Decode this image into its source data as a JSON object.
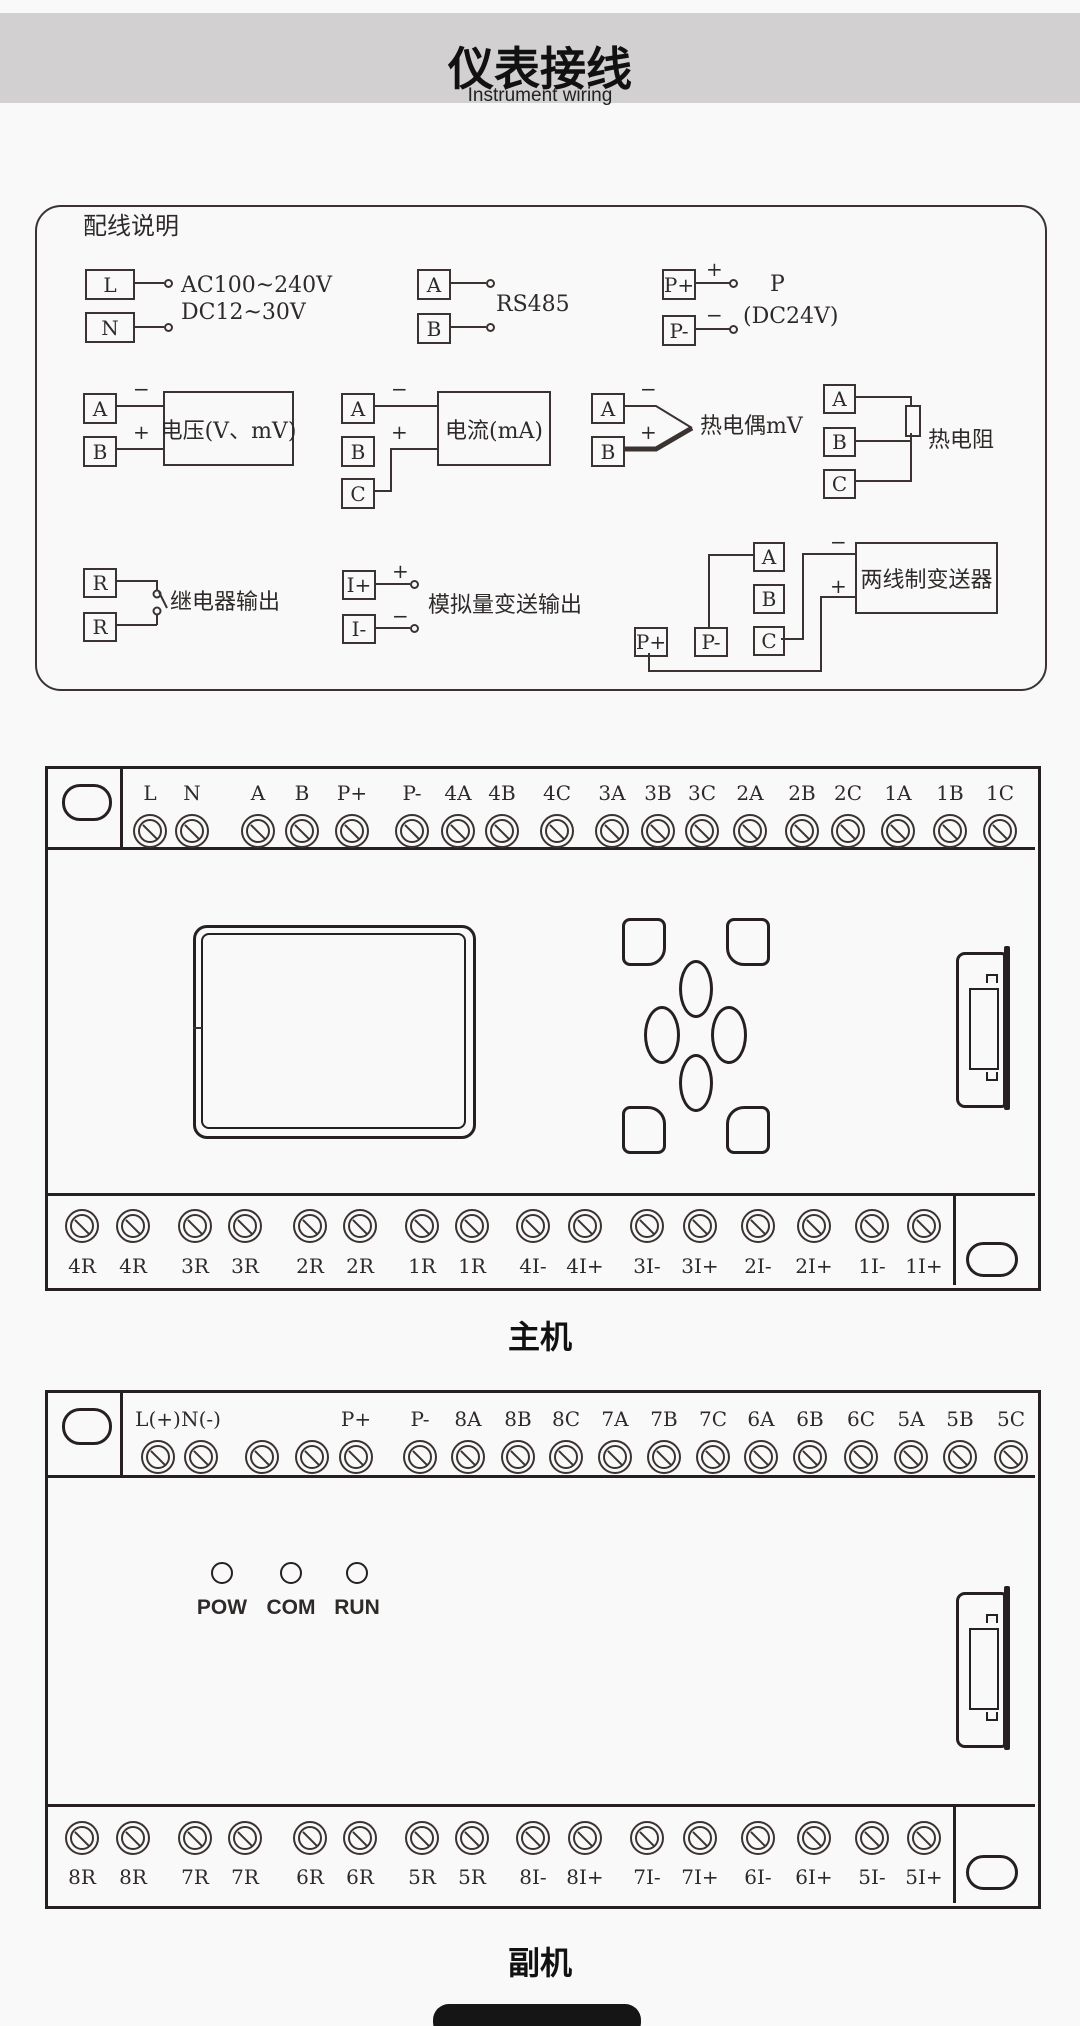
{
  "header": {
    "title": "仪表接线",
    "subtitle": "Instrument wiring"
  },
  "wiring_box": {
    "title": "配线说明",
    "power": {
      "t1": "L",
      "t2": "N",
      "label1": "AC100~240V",
      "label2": "DC12~30V"
    },
    "rs485": {
      "t1": "A",
      "t2": "B",
      "label": "RS485"
    },
    "dc24": {
      "t1": "P+",
      "t2": "P-",
      "plus": "+",
      "minus": "−",
      "label1": "P",
      "label2": "(DC24V)"
    },
    "voltage": {
      "t1": "A",
      "t2": "B",
      "minus": "−",
      "plus": "+",
      "label": "电压(V、mV)"
    },
    "current": {
      "t1": "A",
      "t2": "B",
      "t3": "C",
      "minus": "−",
      "plus": "+",
      "label": "电流(mA)"
    },
    "thermocouple": {
      "t1": "A",
      "t2": "B",
      "minus": "−",
      "plus": "+",
      "label": "热电偶mV"
    },
    "rtd": {
      "t1": "A",
      "t2": "B",
      "t3": "C",
      "label": "热电阻"
    },
    "relay": {
      "t1": "R",
      "t2": "R",
      "label": "继电器输出"
    },
    "analog_out": {
      "t1": "I+",
      "t2": "I-",
      "plus": "+",
      "minus": "−",
      "label": "模拟量变送输出"
    },
    "transmitter": {
      "t1": "P+",
      "t2": "P-",
      "t3": "A",
      "t4": "B",
      "t5": "C",
      "minus": "−",
      "plus": "+",
      "label": "两线制变送器"
    }
  },
  "main_unit": {
    "caption": "主机",
    "top_terminals": [
      "L",
      "N",
      "A",
      "B",
      "P+",
      "P-",
      "4A",
      "4B",
      "4C",
      "3A",
      "3B",
      "3C",
      "2A",
      "2B",
      "2C",
      "1A",
      "1B",
      "1C"
    ],
    "bottom_terminals": [
      "4R",
      "4R",
      "3R",
      "3R",
      "2R",
      "2R",
      "1R",
      "1R",
      "4I-",
      "4I+",
      "3I-",
      "3I+",
      "2I-",
      "2I+",
      "1I-",
      "1I+"
    ]
  },
  "aux_unit": {
    "caption": "副机",
    "top_terminals": [
      "L(+)",
      "N(-)",
      "",
      "",
      "P+",
      "P-",
      "8A",
      "8B",
      "8C",
      "7A",
      "7B",
      "7C",
      "6A",
      "6B",
      "6C",
      "5A",
      "5B",
      "5C"
    ],
    "bottom_terminals": [
      "8R",
      "8R",
      "7R",
      "7R",
      "6R",
      "6R",
      "5R",
      "5R",
      "8I-",
      "8I+",
      "7I-",
      "7I+",
      "6I-",
      "6I+",
      "5I-",
      "5I+"
    ],
    "leds": [
      "POW",
      "COM",
      "RUN"
    ]
  },
  "colors": {
    "header_bg": "#d2d0d1",
    "line": "#3a3332",
    "page_bg": "#faf9f9"
  }
}
